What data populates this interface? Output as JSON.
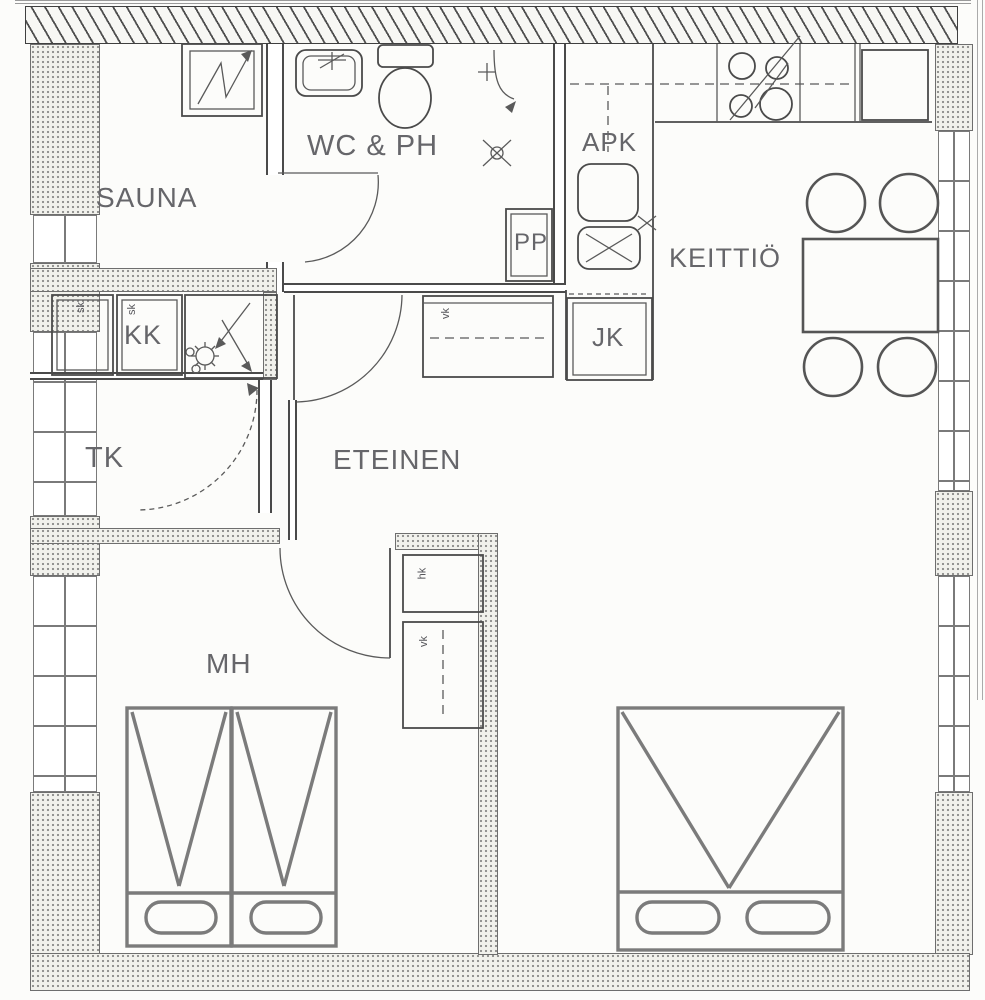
{
  "document": {
    "kind": "apartment-floor-plan"
  },
  "labels": {
    "sauna": "SAUNA",
    "wc_ph": "WC & PH",
    "apk": "APK",
    "keittio": "KEITTIÖ",
    "pp": "PP",
    "jk": "JK",
    "kk": "KK",
    "tk": "TK",
    "eteinen": "ETEINEN",
    "mh": "MH"
  },
  "closet_labels": {
    "sk_1": "sk",
    "sk_2": "sk",
    "vk_eteinen": "vk",
    "hk_mh": "hk",
    "vk_mh": "vk"
  },
  "colors": {
    "wall_line": "#4a4a4a",
    "furniture_line": "#7b7b7b",
    "label_text": "#66666a",
    "wall_fill": "#f1f1ec",
    "background": "#fcfcfa"
  }
}
